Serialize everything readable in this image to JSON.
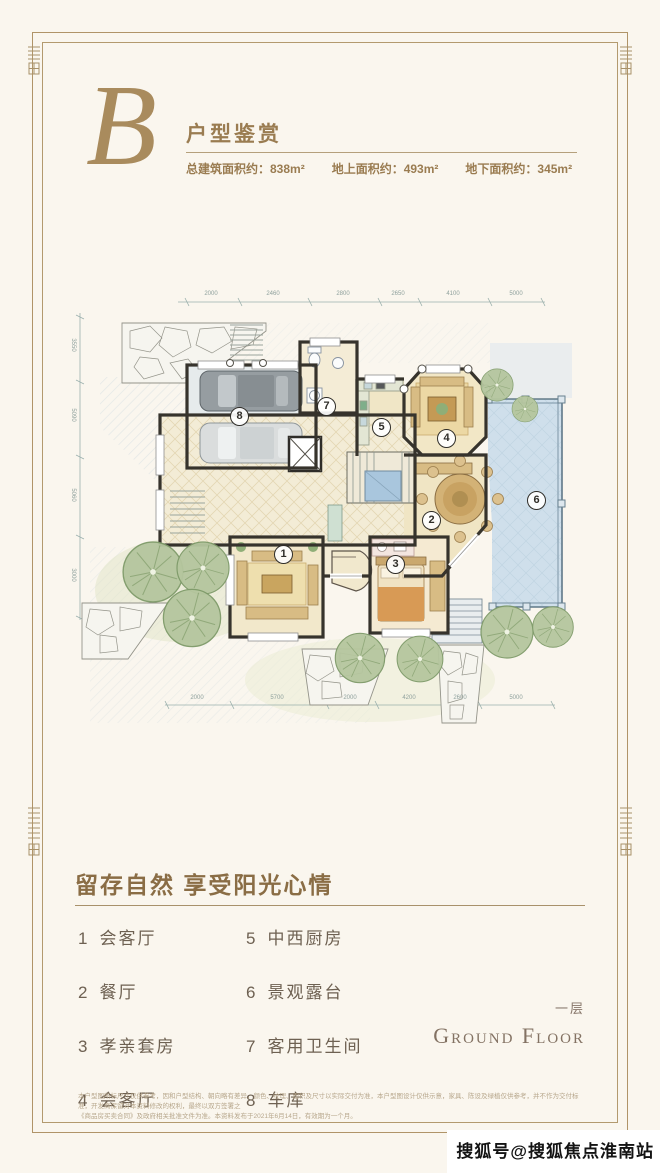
{
  "header": {
    "logo_letter": "B",
    "title": "户型鉴赏",
    "stats": [
      "总建筑面积约：838m²",
      "地上面积约：493m²",
      "地下面积约：345m²"
    ]
  },
  "plan": {
    "badges": [
      "1",
      "2",
      "3",
      "4",
      "5",
      "6",
      "7",
      "8"
    ],
    "top_dims": [
      "2000",
      "2460",
      "2800",
      "2650",
      "4100",
      "5000"
    ],
    "bottom_dims": [
      "2000",
      "5700",
      "2000",
      "4200",
      "2600",
      "5000"
    ],
    "left_dims": [
      "3550",
      "5090",
      "5060",
      "3000"
    ]
  },
  "section": {
    "headline": "留存自然 享受阳光心情",
    "legend": [
      {
        "num": "1",
        "label": "会客厅"
      },
      {
        "num": "2",
        "label": "餐厅"
      },
      {
        "num": "3",
        "label": "孝亲套房"
      },
      {
        "num": "4",
        "label": "会客厅"
      },
      {
        "num": "5",
        "label": "中西厨房"
      },
      {
        "num": "6",
        "label": "景观露台"
      },
      {
        "num": "7",
        "label": "客用卫生间"
      },
      {
        "num": "8",
        "label": "车库"
      }
    ],
    "floor_label_cn": "一层",
    "floor_label_en": "Ground Floor"
  },
  "disclaimer": {
    "line1": "本户型图所标尺寸仅供参考，因和户型结构、朝向略有差异，颜色、纹理、面积及尺寸以实际交付为准，本户型图设计仅供示意，家具、陈设及绿植仅供参考，并不作为交付标准，开发商保留对本资料修改的权利，最终以双方签署之",
    "line2": "《商品房买卖合同》及政府相关批准文件为准。本资料发布于2021年6月14日，有效期为一个月。"
  },
  "watermark": "搜狐号@搜狐焦点淮南站"
}
